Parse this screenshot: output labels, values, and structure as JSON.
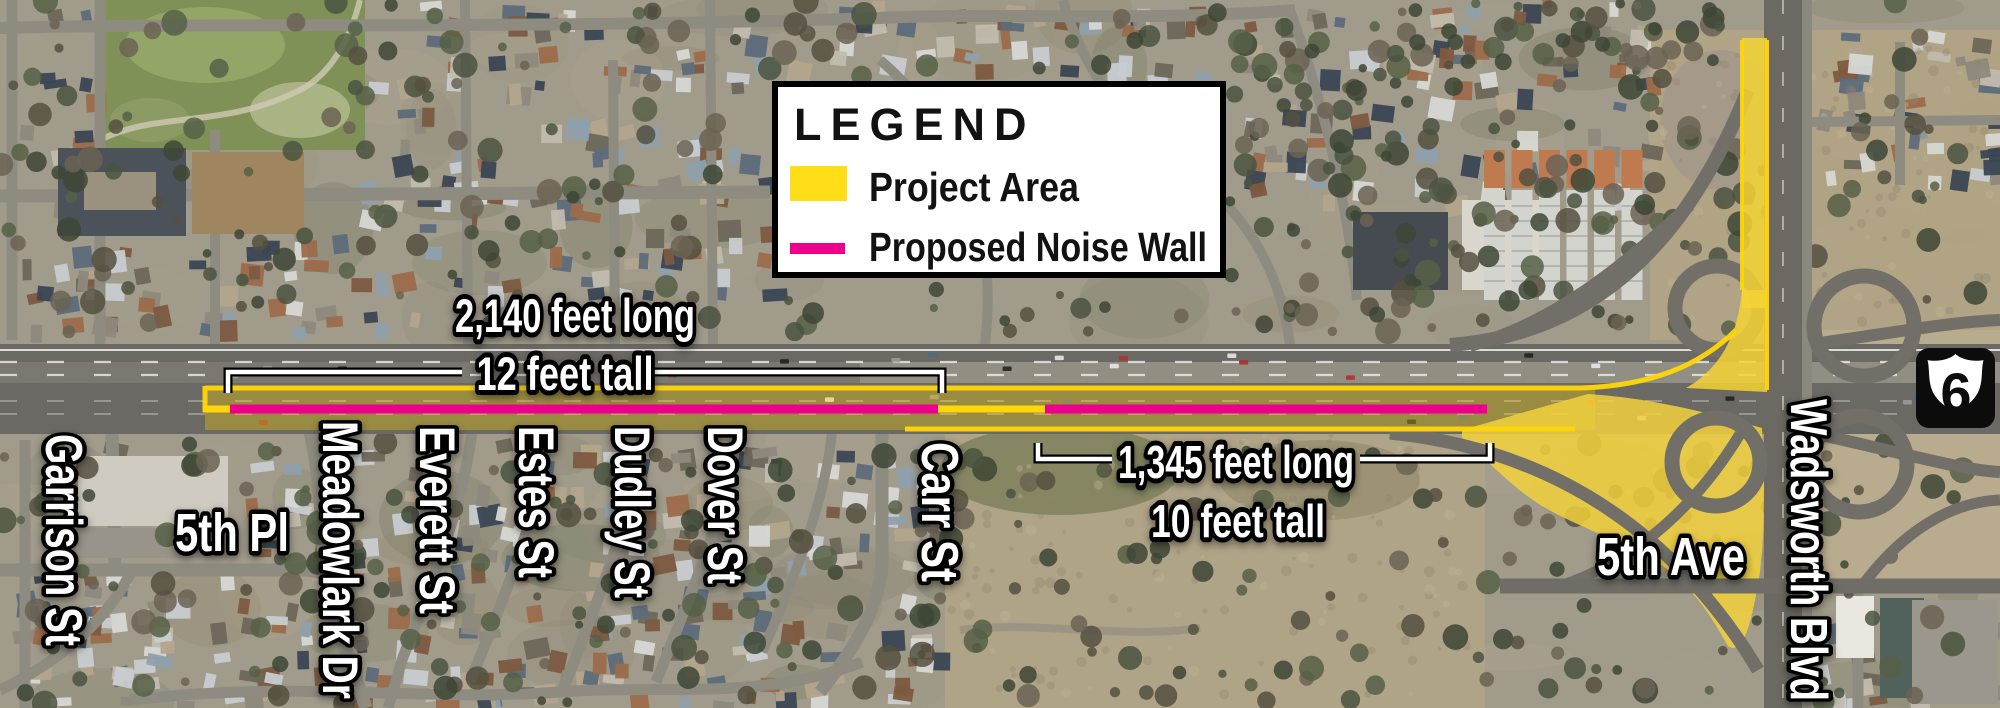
{
  "map": {
    "legend": {
      "title": "LEGEND",
      "items": [
        {
          "label": "Project Area",
          "swatch": "area"
        },
        {
          "label": "Proposed Noise Wall",
          "swatch": "line"
        }
      ]
    },
    "annotations": {
      "wall_west": {
        "length": "2,140 feet long",
        "height": "12 feet tall"
      },
      "wall_east": {
        "length": "1,345 feet long",
        "height": "10 feet tall"
      }
    },
    "streets": {
      "garrison": "Garrison St",
      "fifth_pl": "5th Pl",
      "meadowlark": "Meadowlark Dr",
      "everett": "Everett St",
      "estes": "Estes St",
      "dudley": "Dudley St",
      "dover": "Dover St",
      "carr": "Carr St",
      "fifth_ave": "5th Ave",
      "wadsworth": "Wadsworth Blvd"
    },
    "route_shield": {
      "number": "6"
    },
    "colors": {
      "project_area": "#FFD60A",
      "project_area_swatch": "#FFDE17",
      "noise_wall": "#EC008C"
    }
  }
}
